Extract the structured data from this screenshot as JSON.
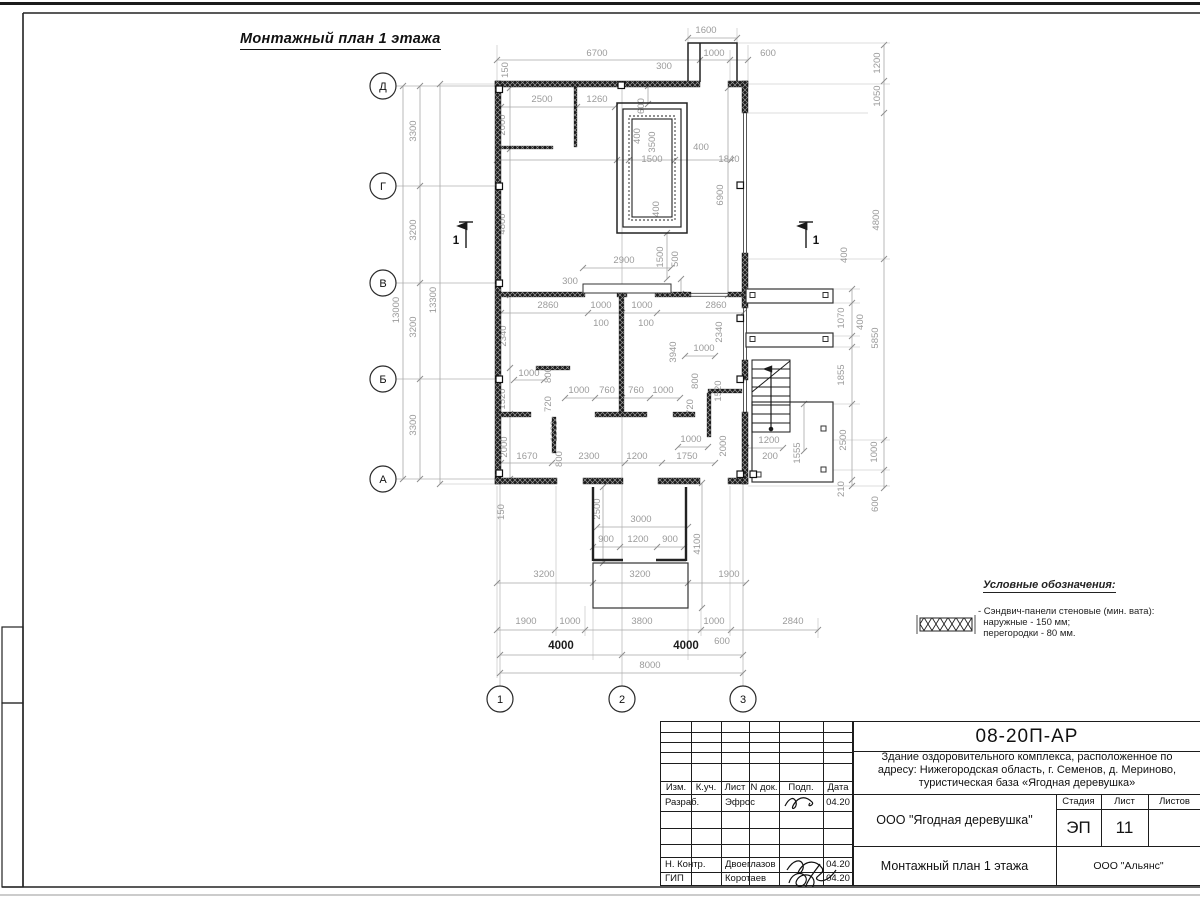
{
  "sheet": {
    "plan_title": "Монтажный план 1 этажа"
  },
  "legend": {
    "title": "Условные обозначения:",
    "item_line1": "- Сэндвич-панели стеновые (мин. вата):",
    "item_line2": "наружные - 150 мм;",
    "item_line3": "перегородки - 80 мм.",
    "symbol": "cross-hatch-wall"
  },
  "title_block": {
    "doc_number": "08-20П-АР",
    "project_line1": "Здание оздоровительного комплекса, расположенное по",
    "project_line2": "адресу: Нижегородская область, г. Семенов, д. Мериново,",
    "project_line3": "туристическая база «Ягодная деревушка»",
    "org": "ООО \"Ягодная деревушка\"",
    "drawing_title": "Монтажный план 1 этажа",
    "contractor": "ООО \"Альянс\"",
    "stage_label": "Стадия",
    "sheet_label": "Лист",
    "sheets_label": "Листов",
    "stage": "ЭП",
    "sheet_no": "11",
    "cols": [
      "Изм.",
      "К.уч.",
      "Лист",
      "N док.",
      "Подп.",
      "Дата"
    ],
    "rows": [
      {
        "role": "Разраб.",
        "name": "Эфрос",
        "date": "04.20"
      },
      {
        "role": "Н. Контр.",
        "name": "Двоеглазов",
        "date": "04.20"
      },
      {
        "role": "ГИП",
        "name": "Коротаев",
        "date": "04.20"
      }
    ]
  },
  "axes": {
    "rows": [
      {
        "label": "Д",
        "y": 86
      },
      {
        "label": "Г",
        "y": 186
      },
      {
        "label": "В",
        "y": 283
      },
      {
        "label": "Б",
        "y": 379
      },
      {
        "label": "А",
        "y": 479
      }
    ],
    "cols": [
      {
        "label": "1",
        "x": 500,
        "top": 480
      },
      {
        "label": "2",
        "x": 622,
        "top": 84
      },
      {
        "label": "3",
        "x": 743,
        "top": 480
      }
    ]
  },
  "section_marks": [
    {
      "label": "1",
      "x": 466,
      "y": 222,
      "side": "left"
    },
    {
      "label": "1",
      "x": 806,
      "y": 222,
      "side": "right"
    }
  ],
  "dimensions": [
    [
      "1600",
      706,
      33,
      "h"
    ],
    [
      "6700",
      597,
      56,
      "h"
    ],
    [
      "1000",
      714,
      56,
      "h"
    ],
    [
      "600",
      768,
      56,
      "h"
    ],
    [
      "300",
      664,
      69,
      "h"
    ],
    [
      "150",
      508,
      70,
      "v"
    ],
    [
      "2500",
      542,
      102,
      "h"
    ],
    [
      "1260",
      597,
      102,
      "h"
    ],
    [
      "2000",
      505,
      125,
      "v"
    ],
    [
      "600",
      644,
      106,
      "v"
    ],
    [
      "400",
      640,
      136,
      "v"
    ],
    [
      "3500",
      655,
      142,
      "v"
    ],
    [
      "1500",
      652,
      162,
      "h"
    ],
    [
      "400",
      701,
      150,
      "h"
    ],
    [
      "1840",
      729,
      162,
      "h"
    ],
    [
      "400",
      659,
      209,
      "v"
    ],
    [
      "4800",
      505,
      224,
      "v"
    ],
    [
      "6900",
      723,
      195,
      "v"
    ],
    [
      "1500",
      663,
      257,
      "v"
    ],
    [
      "500",
      678,
      259,
      "v"
    ],
    [
      "2900",
      624,
      263,
      "h"
    ],
    [
      "300",
      570,
      284,
      "h"
    ],
    [
      "2860",
      548,
      308,
      "h"
    ],
    [
      "1000",
      601,
      308,
      "h"
    ],
    [
      "1000",
      642,
      308,
      "h"
    ],
    [
      "2860",
      716,
      308,
      "h"
    ],
    [
      "100",
      601,
      326,
      "h"
    ],
    [
      "100",
      646,
      326,
      "h"
    ],
    [
      "2340",
      506,
      336,
      "v"
    ],
    [
      "2340",
      722,
      332,
      "v"
    ],
    [
      "3940",
      676,
      352,
      "v"
    ],
    [
      "1000",
      704,
      351,
      "h"
    ],
    [
      "800",
      551,
      375,
      "v"
    ],
    [
      "720",
      551,
      404,
      "v"
    ],
    [
      "800",
      698,
      381,
      "v"
    ],
    [
      "720",
      693,
      407,
      "v"
    ],
    [
      "1000",
      529,
      376,
      "h"
    ],
    [
      "1520",
      505,
      399,
      "v"
    ],
    [
      "1520",
      721,
      391,
      "v"
    ],
    [
      "1000",
      579,
      393,
      "h"
    ],
    [
      "760",
      607,
      393,
      "h"
    ],
    [
      "760",
      636,
      393,
      "h"
    ],
    [
      "1000",
      663,
      393,
      "h"
    ],
    [
      "1000",
      557,
      431,
      "v"
    ],
    [
      "800",
      562,
      459,
      "v"
    ],
    [
      "2000",
      507,
      447,
      "v"
    ],
    [
      "1000",
      691,
      442,
      "h"
    ],
    [
      "2000",
      726,
      446,
      "v"
    ],
    [
      "1200",
      769,
      443,
      "h"
    ],
    [
      "200",
      770,
      459,
      "h"
    ],
    [
      "1670",
      527,
      459,
      "h"
    ],
    [
      "2300",
      589,
      459,
      "h"
    ],
    [
      "1200",
      637,
      459,
      "h"
    ],
    [
      "1750",
      687,
      459,
      "h"
    ],
    [
      "150",
      504,
      512,
      "v"
    ],
    [
      "2500",
      600,
      509,
      "v"
    ],
    [
      "3000",
      641,
      522,
      "h"
    ],
    [
      "900",
      606,
      542,
      "h"
    ],
    [
      "1200",
      638,
      542,
      "h"
    ],
    [
      "900",
      670,
      542,
      "h"
    ],
    [
      "4100",
      700,
      544,
      "v"
    ],
    [
      "3200",
      544,
      577,
      "h"
    ],
    [
      "3200",
      640,
      577,
      "h"
    ],
    [
      "1900",
      729,
      577,
      "h"
    ],
    [
      "1900",
      526,
      624,
      "h"
    ],
    [
      "1000",
      570,
      624,
      "h"
    ],
    [
      "3800",
      642,
      624,
      "h"
    ],
    [
      "1000",
      714,
      624,
      "h"
    ],
    [
      "2840",
      793,
      624,
      "h"
    ],
    [
      "600",
      722,
      644,
      "h"
    ],
    [
      "4000",
      561,
      649,
      "h",
      "d"
    ],
    [
      "4000",
      686,
      649,
      "h",
      "d"
    ],
    [
      "8000",
      650,
      668,
      "h"
    ],
    [
      "3300",
      416,
      131,
      "v"
    ],
    [
      "3200",
      416,
      230,
      "v"
    ],
    [
      "3200",
      416,
      327,
      "v"
    ],
    [
      "3300",
      416,
      425,
      "v"
    ],
    [
      "13000",
      399,
      310,
      "v"
    ],
    [
      "13300",
      436,
      300,
      "v"
    ],
    [
      "1200",
      880,
      63,
      "v"
    ],
    [
      "1050",
      880,
      96,
      "v"
    ],
    [
      "4800",
      879,
      220,
      "v"
    ],
    [
      "400",
      847,
      255,
      "v"
    ],
    [
      "1070",
      844,
      318,
      "v"
    ],
    [
      "400",
      863,
      322,
      "v"
    ],
    [
      "5850",
      878,
      338,
      "v"
    ],
    [
      "1855",
      844,
      375,
      "v"
    ],
    [
      "2500",
      846,
      440,
      "v"
    ],
    [
      "1000",
      877,
      452,
      "v"
    ],
    [
      "1555",
      800,
      453,
      "v"
    ],
    [
      "210",
      844,
      489,
      "v"
    ],
    [
      "600",
      878,
      504,
      "v"
    ]
  ],
  "dim_chains": [
    [
      "h",
      60,
      [
        497,
        700,
        730,
        748
      ]
    ],
    [
      "h",
      38,
      [
        688,
        737
      ]
    ],
    [
      "h",
      107,
      [
        501,
        577,
        615
      ]
    ],
    [
      "h",
      160,
      [
        497,
        617,
        629,
        675,
        731
      ]
    ],
    [
      "h",
      268,
      [
        583,
        671
      ]
    ],
    [
      "h",
      313,
      [
        501,
        588,
        622,
        657,
        743
      ]
    ],
    [
      "h",
      398,
      [
        565,
        595,
        622,
        650,
        680
      ]
    ],
    [
      "h",
      463,
      [
        501,
        552,
        625,
        662,
        715
      ]
    ],
    [
      "h",
      527,
      [
        597,
        688
      ]
    ],
    [
      "h",
      547,
      [
        593,
        620,
        657,
        684
      ]
    ],
    [
      "h",
      583,
      [
        497,
        593,
        688,
        746
      ]
    ],
    [
      "h",
      630,
      [
        497,
        555,
        585,
        701,
        731,
        818
      ]
    ],
    [
      "h",
      655,
      [
        500,
        622,
        743
      ]
    ],
    [
      "h",
      673,
      [
        500,
        743
      ]
    ],
    [
      "h",
      356,
      [
        685,
        715
      ]
    ],
    [
      "h",
      380,
      [
        514,
        544
      ]
    ],
    [
      "h",
      447,
      [
        678,
        708
      ]
    ],
    [
      "h",
      448,
      [
        746,
        783
      ]
    ],
    [
      "v",
      403,
      [
        86,
        479
      ]
    ],
    [
      "v",
      420,
      [
        86,
        186,
        283,
        379,
        479
      ]
    ],
    [
      "v",
      440,
      [
        84,
        484
      ]
    ],
    [
      "v",
      510,
      [
        88,
        149,
        295,
        368,
        414,
        479
      ]
    ],
    [
      "v",
      648,
      [
        86,
        104
      ]
    ],
    [
      "v",
      728,
      [
        88,
        295
      ]
    ],
    [
      "v",
      603,
      [
        487,
        563
      ]
    ],
    [
      "v",
      702,
      [
        483,
        608
      ]
    ],
    [
      "v",
      852,
      [
        289,
        303,
        336,
        347,
        404,
        480,
        486
      ]
    ],
    [
      "v",
      884,
      [
        45,
        81,
        113,
        259,
        440,
        470,
        488
      ]
    ],
    [
      "v",
      667,
      [
        233,
        279
      ]
    ],
    [
      "v",
      681,
      [
        279,
        294
      ]
    ],
    [
      "v",
      804,
      [
        404,
        451
      ]
    ]
  ]
}
